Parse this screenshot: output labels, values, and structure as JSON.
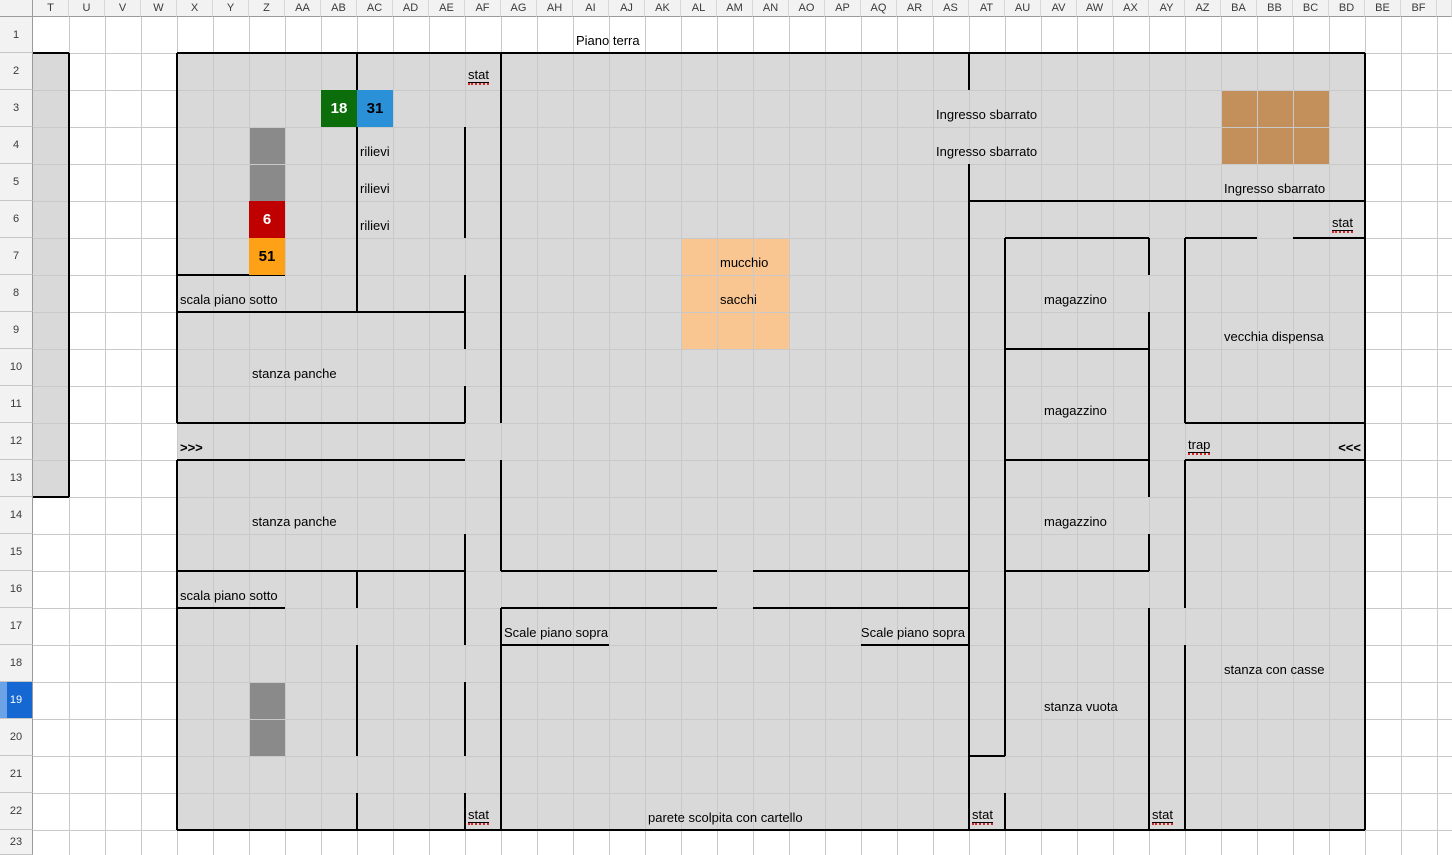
{
  "sheet": {
    "columns": [
      "T",
      "U",
      "V",
      "W",
      "X",
      "Y",
      "Z",
      "AA",
      "AB",
      "AC",
      "AD",
      "AE",
      "AF",
      "AG",
      "AH",
      "AI",
      "AJ",
      "AK",
      "AL",
      "AM",
      "AN",
      "AO",
      "AP",
      "AQ",
      "AR",
      "AS",
      "AT",
      "AU",
      "AV",
      "AW",
      "AX",
      "AY",
      "AZ",
      "BA",
      "BB",
      "BC",
      "BD",
      "BE",
      "BF",
      ""
    ],
    "rows": [
      "1",
      "2",
      "3",
      "4",
      "5",
      "6",
      "7",
      "8",
      "9",
      "10",
      "11",
      "12",
      "13",
      "14",
      "15",
      "16",
      "17",
      "18",
      "19",
      "20",
      "21",
      "22",
      "23"
    ],
    "selected_row": "19"
  },
  "colors": {
    "map_gray": "#d9d9d9",
    "dark_gray": "#8a8a8a",
    "green": "#0b6e0b",
    "blue": "#2a90d8",
    "red": "#c00000",
    "orange": "#ffa117",
    "peach": "#f9c591",
    "tan": "#c3905c",
    "wall": "#000000",
    "gridline": "#c9c9c9",
    "header_bg": "#f2f2f2",
    "selected_row_bg": "#1568d2",
    "squiggle_red": "#dd2222"
  },
  "map": {
    "fills": [
      {
        "range": "T2:T13",
        "color": "map_gray"
      },
      {
        "range": "X2:BD22",
        "color": "map_gray"
      },
      {
        "range": "Z4:Z5",
        "color": "dark_gray"
      },
      {
        "range": "Z19:Z20",
        "color": "dark_gray"
      },
      {
        "range": "AL7:AN9",
        "color": "peach"
      },
      {
        "range": "BA3:BC4",
        "color": "tan"
      }
    ],
    "value_cells": [
      {
        "cell": "AB3",
        "text": "18",
        "color": "green",
        "text_color": "#ffffff"
      },
      {
        "cell": "AC3",
        "text": "31",
        "color": "blue",
        "text_color": "#000000"
      },
      {
        "cell": "Z6",
        "text": "6",
        "color": "red",
        "text_color": "#ffffff"
      },
      {
        "cell": "Z7",
        "text": "51",
        "color": "orange",
        "text_color": "#000000"
      }
    ],
    "labels": [
      {
        "cell": "AI1",
        "text": "Piano terra"
      },
      {
        "cell": "AF2",
        "text": "stat",
        "underline": true,
        "squiggle": true
      },
      {
        "cell": "AS3",
        "text": "Ingresso sbarrato"
      },
      {
        "cell": "AS4",
        "text": "Ingresso sbarrato"
      },
      {
        "cell": "BA5",
        "text": "Ingresso sbarrato"
      },
      {
        "cell": "BD6",
        "text": "stat",
        "underline": true,
        "squiggle": true
      },
      {
        "cell": "AC4",
        "text": "rilievi"
      },
      {
        "cell": "AC5",
        "text": "rilievi"
      },
      {
        "cell": "AC6",
        "text": "rilievi"
      },
      {
        "cell": "AM7",
        "text": "mucchio"
      },
      {
        "cell": "AM8",
        "text": "sacchi"
      },
      {
        "cell": "X8",
        "text": "scala piano sotto"
      },
      {
        "cell": "AV8",
        "text": "magazzino"
      },
      {
        "cell": "BA9",
        "text": "vecchia dispensa"
      },
      {
        "cell": "Z10",
        "text": "stanza panche"
      },
      {
        "cell": "AV11",
        "text": "magazzino"
      },
      {
        "cell": "X12",
        "text": ">>>",
        "bold": true
      },
      {
        "cell": "AZ12",
        "text": "trap",
        "underline": true,
        "squiggle": true
      },
      {
        "cell": "BD12",
        "text": "<<<",
        "bold": true,
        "align": "right"
      },
      {
        "cell": "Z14",
        "text": "stanza panche"
      },
      {
        "cell": "AV14",
        "text": "magazzino"
      },
      {
        "cell": "X16",
        "text": "scala piano sotto"
      },
      {
        "cell": "AG17",
        "text": "Scale piano sopra"
      },
      {
        "cell": "AQ17",
        "text": "Scale piano sopra",
        "align": "right",
        "span_to": "AS17"
      },
      {
        "cell": "BA18",
        "text": "stanza con casse"
      },
      {
        "cell": "AV19",
        "text": "stanza vuota"
      },
      {
        "cell": "AK22",
        "text": "parete scolpita con cartello"
      },
      {
        "cell": "AF22",
        "text": "stat",
        "underline": true,
        "squiggle": true
      },
      {
        "cell": "AT22",
        "text": "stat",
        "underline": true,
        "squiggle": true
      },
      {
        "cell": "AY22",
        "text": "stat",
        "underline": true,
        "squiggle": true
      }
    ],
    "walls": {
      "horizontal": [
        {
          "cols": "T:T",
          "row": 2
        },
        {
          "cols": "X:BD",
          "row": 2
        },
        {
          "cols": "AT:BD",
          "row": 6
        },
        {
          "cols": "AU:AX",
          "row": 7
        },
        {
          "cols": "AZ:BA",
          "row": 7
        },
        {
          "cols": "BC:BD",
          "row": 7
        },
        {
          "cols": "X:Z",
          "row": 8
        },
        {
          "cols": "X:AE",
          "row": 9
        },
        {
          "cols": "AU:AX",
          "row": 10
        },
        {
          "cols": "X:AE",
          "row": 12
        },
        {
          "cols": "AZ:BD",
          "row": 12
        },
        {
          "cols": "X:AE",
          "row": 13
        },
        {
          "cols": "AU:AX",
          "row": 13
        },
        {
          "cols": "AZ:BD",
          "row": 13
        },
        {
          "cols": "T:T",
          "row": 14
        },
        {
          "cols": "X:AE",
          "row": 16
        },
        {
          "cols": "AG:AL",
          "row": 16
        },
        {
          "cols": "AN:AS",
          "row": 16
        },
        {
          "cols": "AU:AX",
          "row": 16
        },
        {
          "cols": "X:Z",
          "row": 17
        },
        {
          "cols": "AG:AL",
          "row": 17
        },
        {
          "cols": "AN:AS",
          "row": 17
        },
        {
          "cols": "AG:AI",
          "row": 18
        },
        {
          "cols": "AQ:AS",
          "row": 18
        },
        {
          "cols": "AT:AT",
          "row": 21
        },
        {
          "cols": "X:BD",
          "row": 23
        }
      ],
      "vertical": [
        {
          "col": "U",
          "rows": [
            2,
            13
          ]
        },
        {
          "col": "X",
          "rows": [
            2,
            11
          ]
        },
        {
          "col": "X",
          "rows": [
            13,
            22
          ]
        },
        {
          "col": "AC",
          "rows": [
            2,
            8
          ]
        },
        {
          "col": "AC",
          "rows": [
            16,
            16
          ]
        },
        {
          "col": "AC",
          "rows": [
            18,
            20
          ]
        },
        {
          "col": "AC",
          "rows": [
            22,
            22
          ]
        },
        {
          "col": "AF",
          "rows": [
            4,
            6
          ]
        },
        {
          "col": "AF",
          "rows": [
            8,
            9
          ]
        },
        {
          "col": "AF",
          "rows": [
            11,
            11
          ]
        },
        {
          "col": "AF",
          "rows": [
            15,
            17
          ]
        },
        {
          "col": "AF",
          "rows": [
            19,
            20
          ]
        },
        {
          "col": "AF",
          "rows": [
            22,
            22
          ]
        },
        {
          "col": "AG",
          "rows": [
            2,
            11
          ]
        },
        {
          "col": "AG",
          "rows": [
            13,
            15
          ]
        },
        {
          "col": "AG",
          "rows": [
            17,
            22
          ]
        },
        {
          "col": "AT",
          "rows": [
            2,
            2
          ]
        },
        {
          "col": "AT",
          "rows": [
            5,
            22
          ]
        },
        {
          "col": "AU",
          "rows": [
            7,
            20
          ]
        },
        {
          "col": "AU",
          "rows": [
            22,
            22
          ]
        },
        {
          "col": "AY",
          "rows": [
            7,
            7
          ]
        },
        {
          "col": "AY",
          "rows": [
            9,
            13
          ]
        },
        {
          "col": "AY",
          "rows": [
            15,
            15
          ]
        },
        {
          "col": "AY",
          "rows": [
            17,
            22
          ]
        },
        {
          "col": "AZ",
          "rows": [
            7,
            11
          ]
        },
        {
          "col": "AZ",
          "rows": [
            13,
            16
          ]
        },
        {
          "col": "AZ",
          "rows": [
            18,
            22
          ]
        },
        {
          "col": "BE",
          "rows": [
            2,
            22
          ]
        }
      ]
    }
  }
}
